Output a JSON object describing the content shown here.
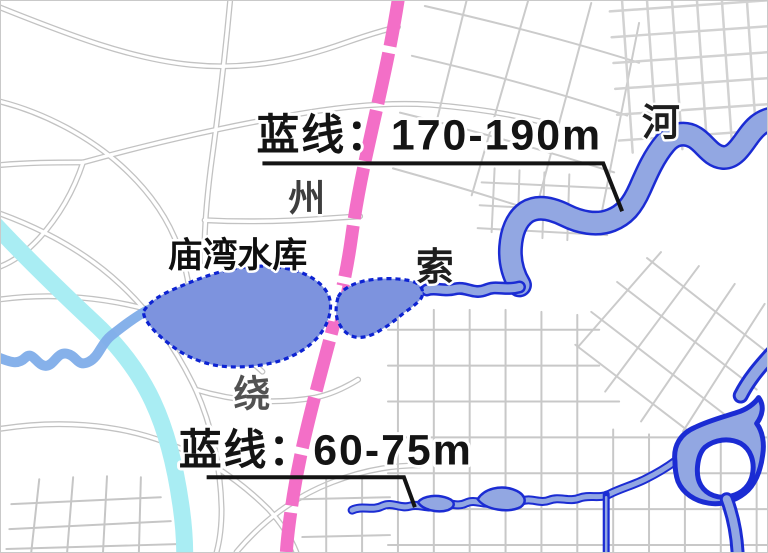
{
  "map": {
    "callouts": {
      "upper": {
        "text": "蓝线：170-190m"
      },
      "lower": {
        "text": "蓝线：60-75m"
      }
    },
    "place_labels": {
      "reservoir": "庙湾水库",
      "zhou": "州",
      "suo": "索",
      "rao": "绕",
      "he": "河"
    },
    "colors": {
      "planning_road_pink": "#f36fc7",
      "water_fill": "#92a7e2",
      "water_outline": "#1b2cd3",
      "reservoir_fill": "#7d93de",
      "reservoir_outline": "#0d23d2",
      "canal_cyan": "#a9edf3",
      "tributary_blue": "#7fade9",
      "base_road_gray": "#c9c9c9",
      "annotation_black": "#141414"
    }
  }
}
